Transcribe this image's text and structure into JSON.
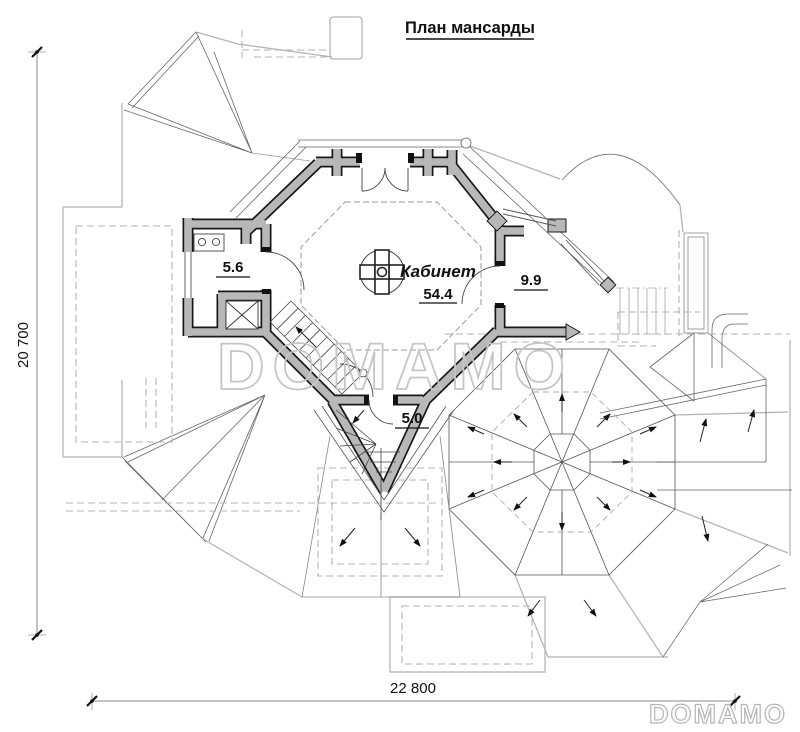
{
  "header": {
    "title": "План мансарды"
  },
  "rooms": {
    "cabinet": {
      "name": "Кабинет",
      "area": "54.4"
    },
    "room_left": {
      "area": "5.6"
    },
    "room_right": {
      "area": "9.9"
    },
    "stairwell": {
      "area": "5.0"
    }
  },
  "dimensions": {
    "height_mm": "20 700",
    "width_mm": "22 800"
  },
  "branding": {
    "watermark": "DOMAMO",
    "logo": "DOMAMO"
  },
  "icons": {
    "center_symbol": "chimney-cross-icon"
  },
  "colors": {
    "wall_fill": "#b8b8b8",
    "wall_outline": "#181818",
    "thin_line": "#555555",
    "light_line": "#b5b5b5",
    "watermark": "#c6c6c6"
  }
}
